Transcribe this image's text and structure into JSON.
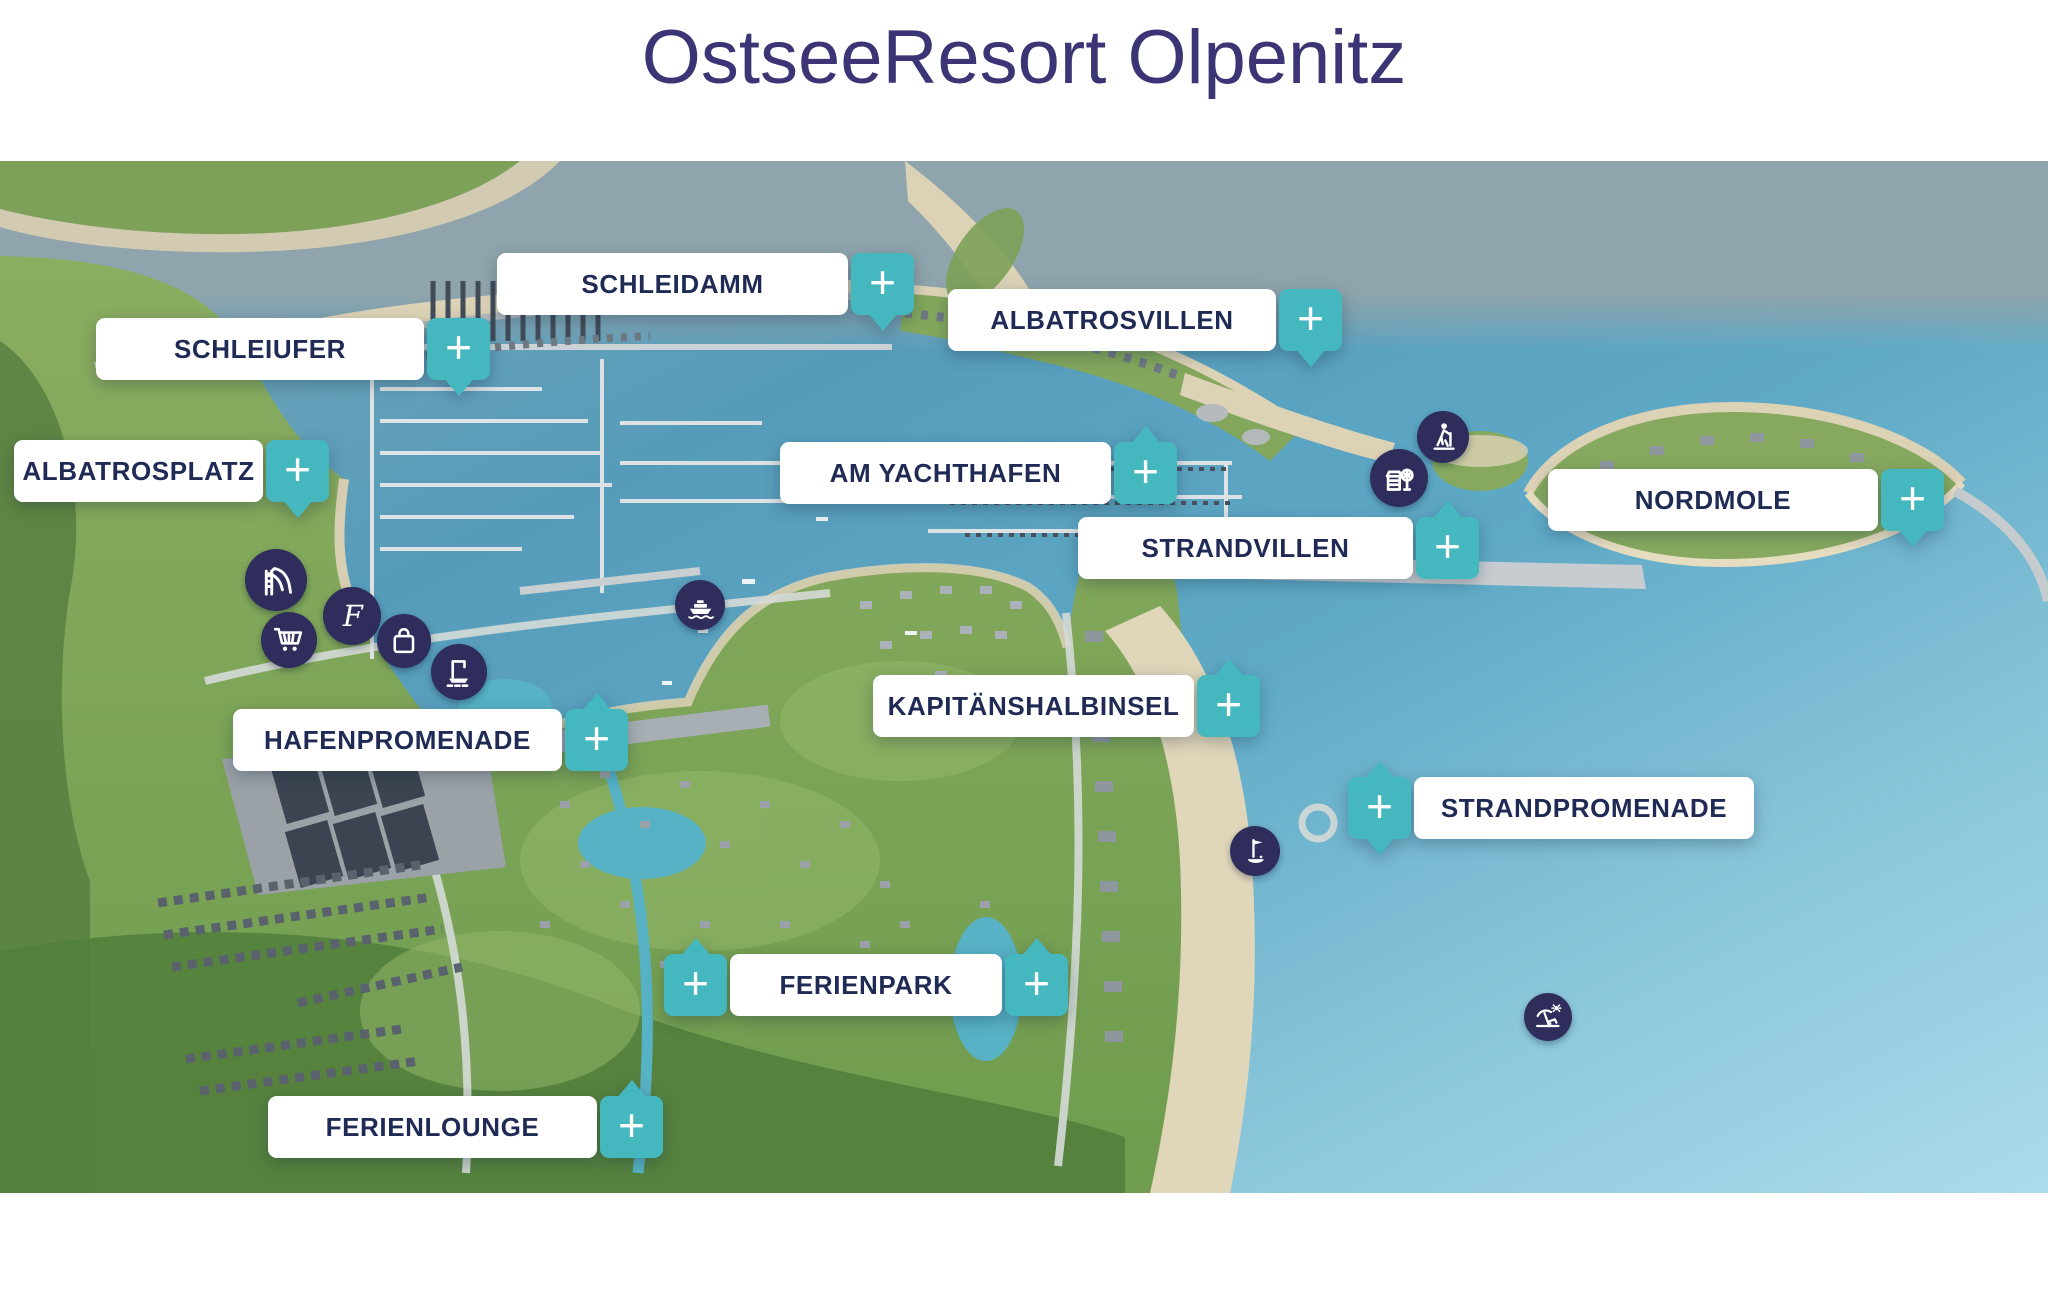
{
  "title": "OstseeResort Olpenitz",
  "ui": {
    "plus_symbol": "+"
  },
  "colors": {
    "accent_teal": "#45b8bf",
    "label_text": "#1f2a55",
    "title_text": "#3b3576",
    "icon_circle": "#2e2d5c",
    "label_background": "#ffffff"
  },
  "areas": [
    {
      "id": "schleidamm",
      "label": "SCHLEIDAMM",
      "x": 497,
      "y": 253,
      "box_width": 351,
      "plus": [
        {
          "side": "right",
          "tail": "down"
        }
      ]
    },
    {
      "id": "schleiufer",
      "label": "SCHLEIUFER",
      "x": 96,
      "y": 318,
      "box_width": 328,
      "plus": [
        {
          "side": "right",
          "tail": "down"
        }
      ]
    },
    {
      "id": "albatrosvillen",
      "label": "ALBATROSVILLEN",
      "x": 948,
      "y": 289,
      "box_width": 328,
      "plus": [
        {
          "side": "right",
          "tail": "down"
        }
      ]
    },
    {
      "id": "albatrosplatz",
      "label": "ALBATROSPLATZ",
      "x": 14,
      "y": 440,
      "box_width": 249,
      "plus": [
        {
          "side": "right",
          "tail": "down"
        }
      ]
    },
    {
      "id": "am-yachthafen",
      "label": "AM YACHTHAFEN",
      "x": 780,
      "y": 442,
      "box_width": 331,
      "plus": [
        {
          "side": "right",
          "tail": "up"
        }
      ]
    },
    {
      "id": "nordmole",
      "label": "NORDMOLE",
      "x": 1548,
      "y": 469,
      "box_width": 330,
      "plus": [
        {
          "side": "right",
          "tail": "down"
        }
      ]
    },
    {
      "id": "strandvillen",
      "label": "STRANDVILLEN",
      "x": 1078,
      "y": 517,
      "box_width": 335,
      "plus": [
        {
          "side": "right",
          "tail": "up"
        }
      ]
    },
    {
      "id": "kapitaenshalbinsel",
      "label": "KAPITÄNSHALBINSEL",
      "x": 873,
      "y": 675,
      "box_width": 321,
      "plus": [
        {
          "side": "right",
          "tail": "up"
        }
      ]
    },
    {
      "id": "hafenpromenade",
      "label": "HAFENPROMENADE",
      "x": 233,
      "y": 709,
      "box_width": 329,
      "plus": [
        {
          "side": "right",
          "tail": "up"
        }
      ]
    },
    {
      "id": "strandpromenade",
      "label": "STRANDPROMENADE",
      "x": 1348,
      "y": 777,
      "box_width": 340,
      "plus": [
        {
          "side": "left",
          "tail": "both"
        }
      ]
    },
    {
      "id": "ferienpark",
      "label": "FERIENPARK",
      "x": 664,
      "y": 954,
      "box_width": 272,
      "plus": [
        {
          "side": "left",
          "tail": "up"
        },
        {
          "side": "right",
          "tail": "up"
        }
      ]
    },
    {
      "id": "ferienlounge",
      "label": "FERIENLOUNGE",
      "x": 268,
      "y": 1096,
      "box_width": 329,
      "plus": [
        {
          "side": "right",
          "tail": "up"
        }
      ]
    }
  ],
  "poi_icons": [
    {
      "name": "waterslide",
      "x": 276,
      "y": 580,
      "d": 62
    },
    {
      "name": "shopping-cart",
      "x": 289,
      "y": 640,
      "d": 56
    },
    {
      "name": "f-logo",
      "x": 352,
      "y": 616,
      "d": 58
    },
    {
      "name": "shopping-bag",
      "x": 404,
      "y": 641,
      "d": 54
    },
    {
      "name": "boat-lift",
      "x": 459,
      "y": 672,
      "d": 56
    },
    {
      "name": "ferry",
      "x": 700,
      "y": 605,
      "d": 50
    },
    {
      "name": "hiker",
      "x": 1443,
      "y": 437,
      "d": 52
    },
    {
      "name": "playground",
      "x": 1399,
      "y": 478,
      "d": 58
    },
    {
      "name": "golf",
      "x": 1255,
      "y": 851,
      "d": 50
    },
    {
      "name": "beach",
      "x": 1548,
      "y": 1017,
      "d": 48
    }
  ]
}
